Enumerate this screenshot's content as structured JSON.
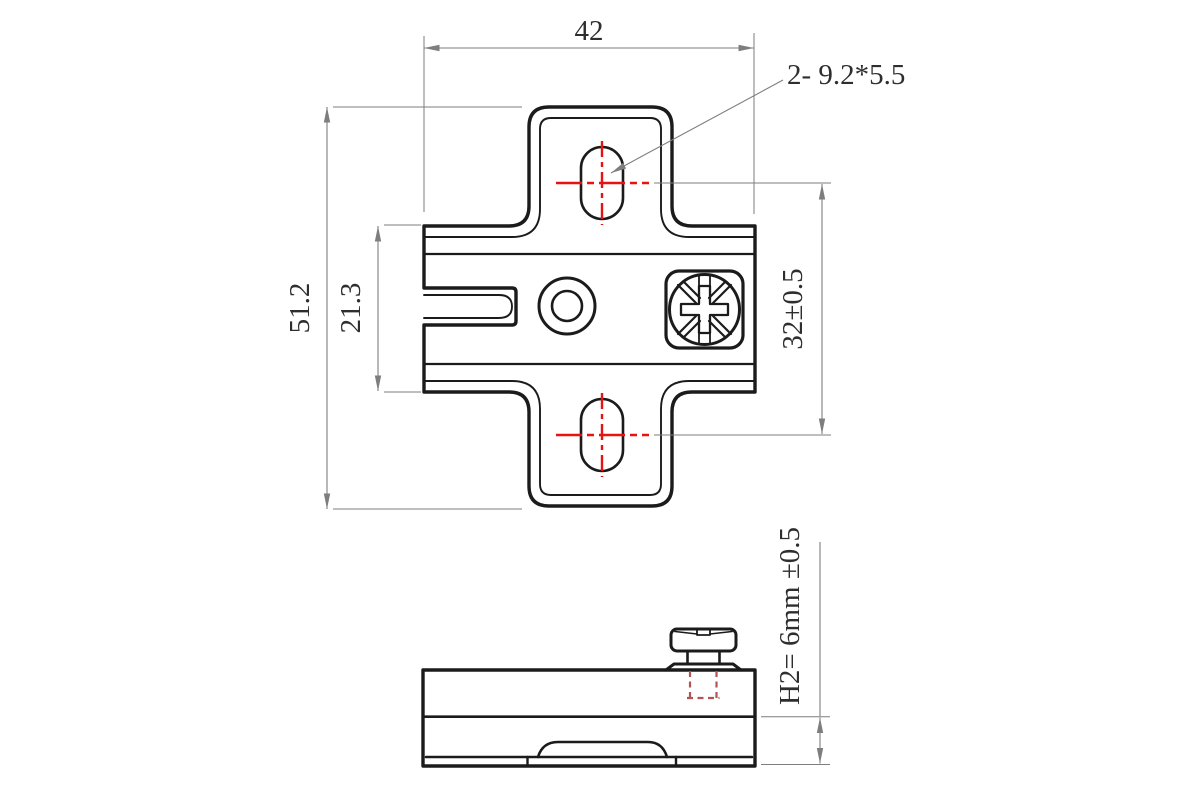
{
  "colors": {
    "outline": "#1b1b1b",
    "dimension": "#7e7e7e",
    "text": "#2e2e2e",
    "centerline": "#e81212",
    "hidden": "#b25454",
    "background": "#ffffff"
  },
  "labels": {
    "dim_width": "42",
    "dim_overall_height": "51.2",
    "dim_body_height": "21.3",
    "dim_hole_spacing": "32±0.5",
    "callout_slots": "2- 9.2*5.5",
    "dim_h2": "H2= 6mm ±0.5"
  }
}
